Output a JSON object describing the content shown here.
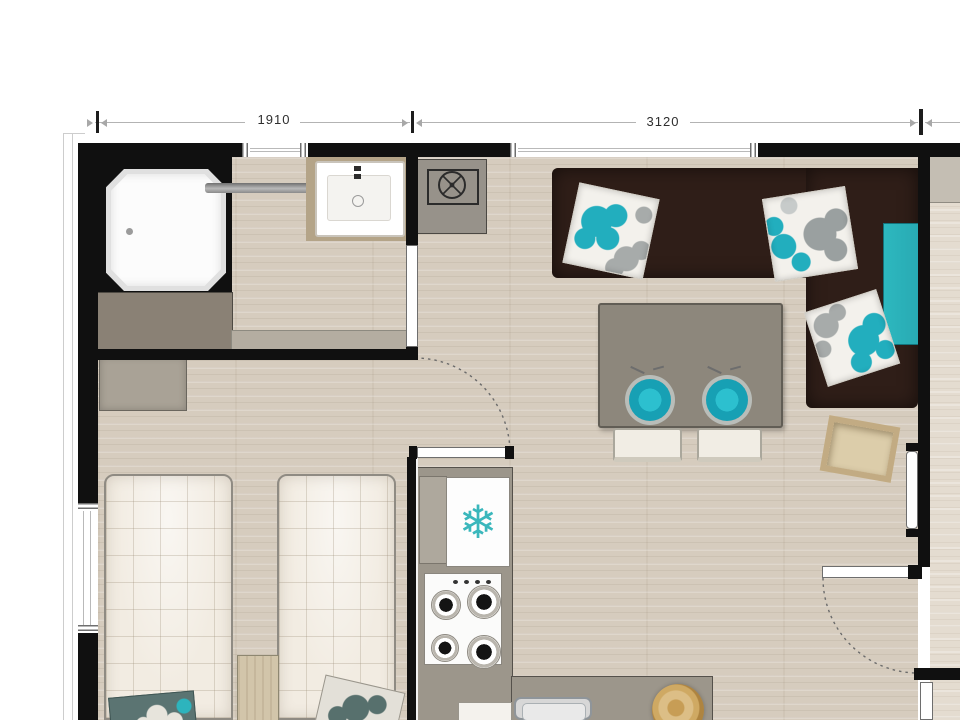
{
  "floor_plan": {
    "dimensions": [
      {
        "name": "bathroom-bedroom-width",
        "value": "1910"
      },
      {
        "name": "living-area-width",
        "value": "3120"
      }
    ],
    "icons": {
      "snowflake": "❄"
    },
    "colors": {
      "wall": "#101010",
      "accent_teal": "#2db4bd",
      "sofa_brown": "#2f1e18",
      "floor_wood": "#d6ccbe",
      "counter_gray": "#9c968b"
    }
  }
}
